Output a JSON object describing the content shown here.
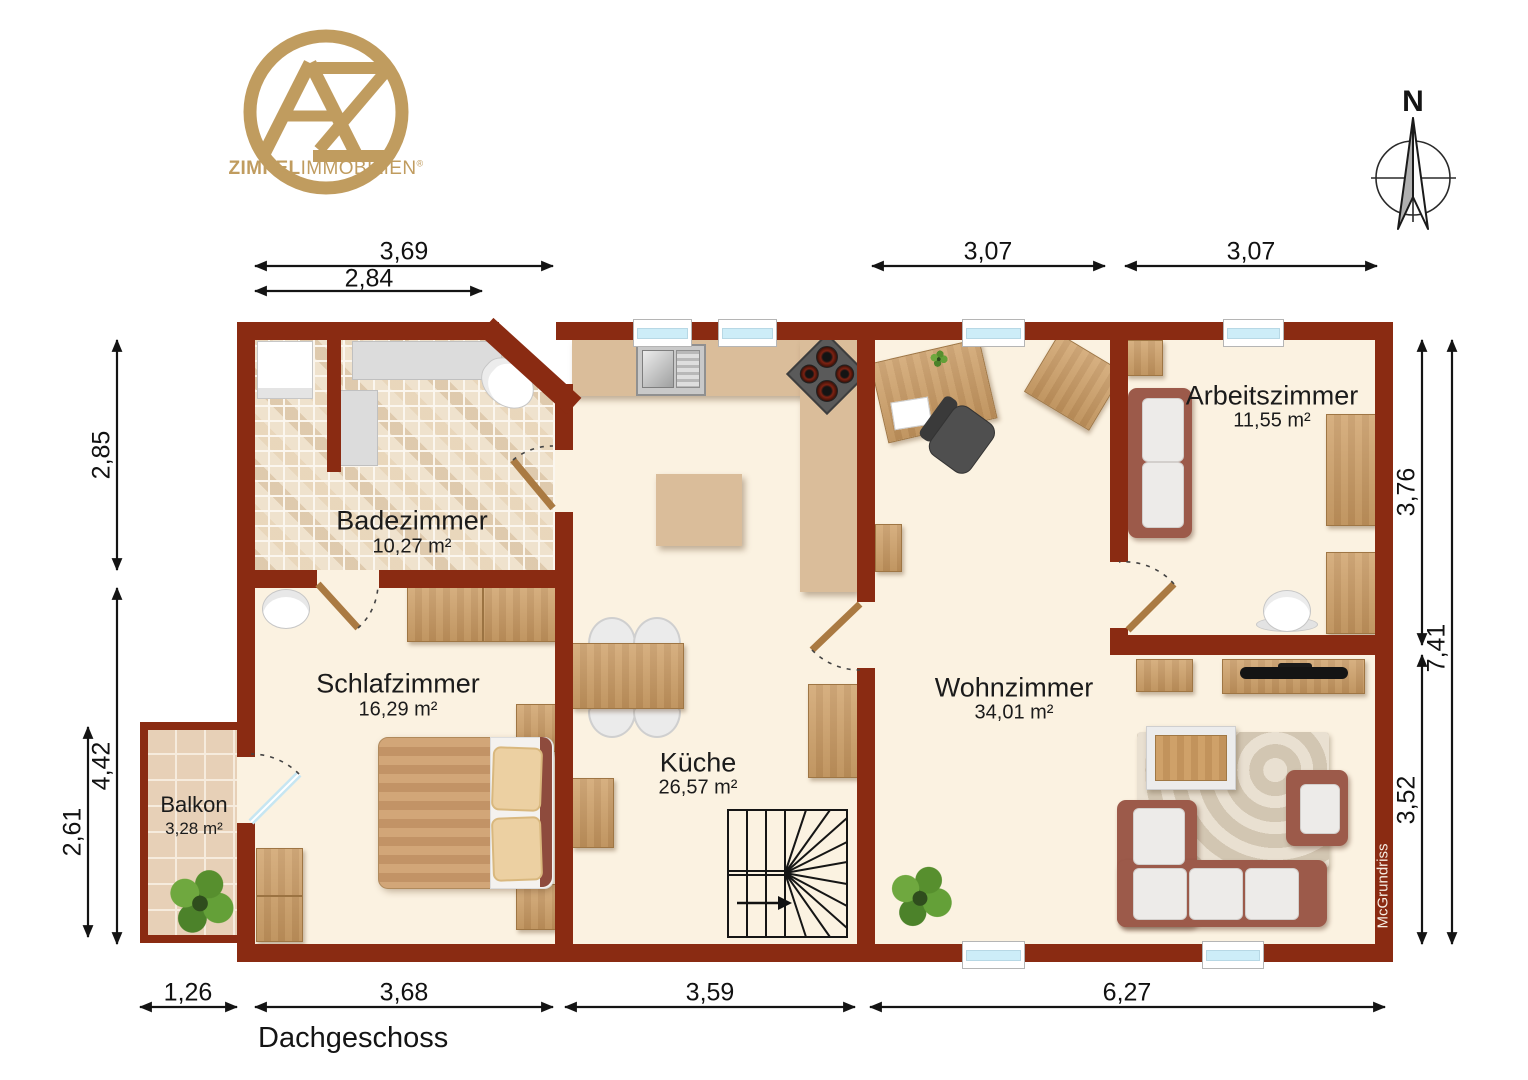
{
  "logo": {
    "bold": "ZIMPEL",
    "light": "IMMOBILIEN",
    "registered": "®"
  },
  "compass": {
    "north": "N"
  },
  "plan": {
    "floor_label": "Dachgeschoss",
    "watermark": "McGrundriss"
  },
  "rooms": {
    "badezimmer": {
      "name": "Badezimmer",
      "area": "10,27 m²"
    },
    "schlafzimmer": {
      "name": "Schlafzimmer",
      "area": "16,29 m²"
    },
    "kueche": {
      "name": "Küche",
      "area": "26,57 m²"
    },
    "wohnzimmer": {
      "name": "Wohnzimmer",
      "area": "34,01 m²"
    },
    "arbeitszimmer": {
      "name": "Arbeitszimmer",
      "area": "11,55 m²"
    },
    "balkon": {
      "name": "Balkon",
      "area": "3,28 m²"
    }
  },
  "dims": {
    "top_outer": "3,69",
    "top_inner": "2,84",
    "top_right_a": "3,07",
    "top_right_b": "3,07",
    "left_upper": "2,85",
    "left_lower": "4,42",
    "balcony_height": "2,61",
    "right_upper": "3,76",
    "right_total": "7,41",
    "right_lower": "3,52",
    "balcony_width": "1,26",
    "bottom_bedroom": "3,68",
    "bottom_kitchen": "3,59",
    "bottom_living": "6,27"
  },
  "colors": {
    "wall": "#8a2b12",
    "floor": "#fbf2e1",
    "gold": "#c09c5f",
    "counter": "#dabd9a",
    "sofa": "#9c5a4a"
  }
}
